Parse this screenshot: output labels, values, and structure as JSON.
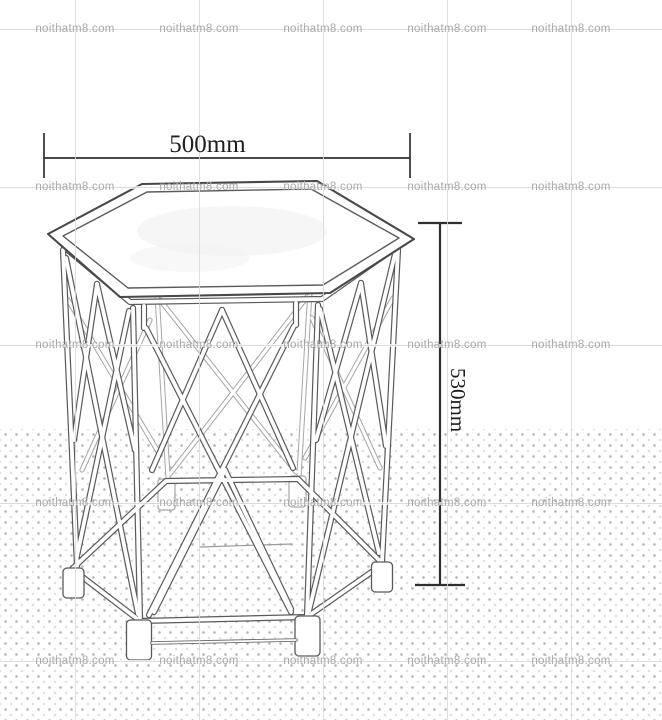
{
  "canvas": {
    "width": 662,
    "height": 720,
    "background": "#ffffff"
  },
  "watermark": {
    "text": "noithatm8.com",
    "color": "#a9a9a9",
    "grid_line_color": "#d9d9d9",
    "columns_x": [
      75,
      199,
      323,
      447,
      571
    ],
    "rows_y": [
      29,
      187,
      345,
      503,
      661
    ]
  },
  "dot_texture": {
    "top": 429,
    "spacing_px": 11,
    "dot_color": "#b5b5b5"
  },
  "dimensions": {
    "width": {
      "label": "500mm"
    },
    "height": {
      "label": "530mm"
    }
  },
  "drawing": {
    "subject": "hexagonal-lattice-side-table-sketch",
    "stroke_color": "#5a5a5a",
    "back_stroke_color": "#a6a6a6",
    "dimension_line_color": "#2f2f2f"
  }
}
